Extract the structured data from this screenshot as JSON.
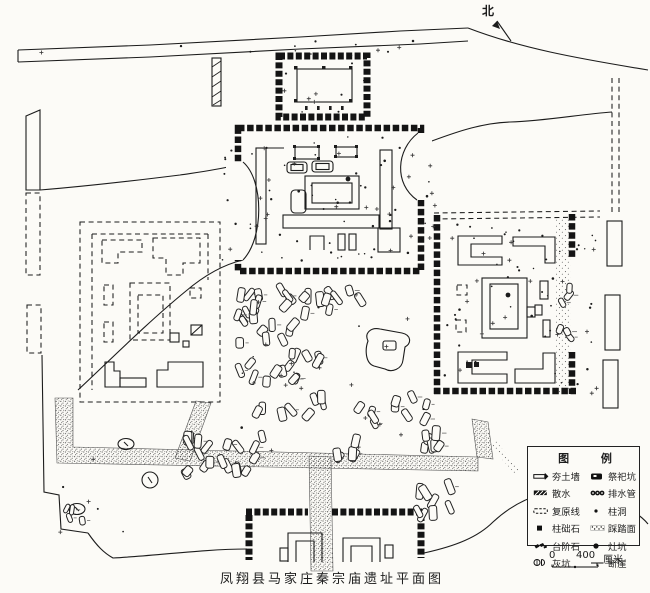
{
  "map": {
    "title": "凤翔县马家庄秦宗庙遗址平面图",
    "north_label": "北"
  },
  "legend": {
    "title": "图 例",
    "rows": [
      {
        "left": {
          "symbol": "rammed-earth-wall",
          "label": "夯土墙"
        },
        "right": {
          "symbol": "sacrificial-pit",
          "label": "祭祀坑"
        }
      },
      {
        "left": {
          "symbol": "apron-drainage",
          "label": "散水"
        },
        "right": {
          "symbol": "drain-pipe",
          "label": "排水管"
        }
      },
      {
        "left": {
          "symbol": "restoration-line",
          "label": "复原线"
        },
        "right": {
          "symbol": "post-hole",
          "label": "柱洞"
        }
      },
      {
        "left": {
          "symbol": "column-base-stone",
          "label": "柱础石"
        },
        "right": {
          "symbol": "trampled-surface",
          "label": "踩踏面"
        }
      },
      {
        "left": {
          "symbol": "step-stone",
          "label": "台阶石"
        },
        "right": {
          "symbol": "hearth-pit",
          "label": "灶坑"
        }
      },
      {
        "left": {
          "symbol": "ash-pit",
          "label": "灰坑"
        },
        "right": {
          "symbol": "scarp",
          "label": "断崖"
        }
      }
    ]
  },
  "scale_bar": {
    "start": "0",
    "end": "400",
    "unit": "厘米"
  },
  "colors": {
    "ink": "#1c1c1c",
    "paper": "#fcfbf7"
  }
}
